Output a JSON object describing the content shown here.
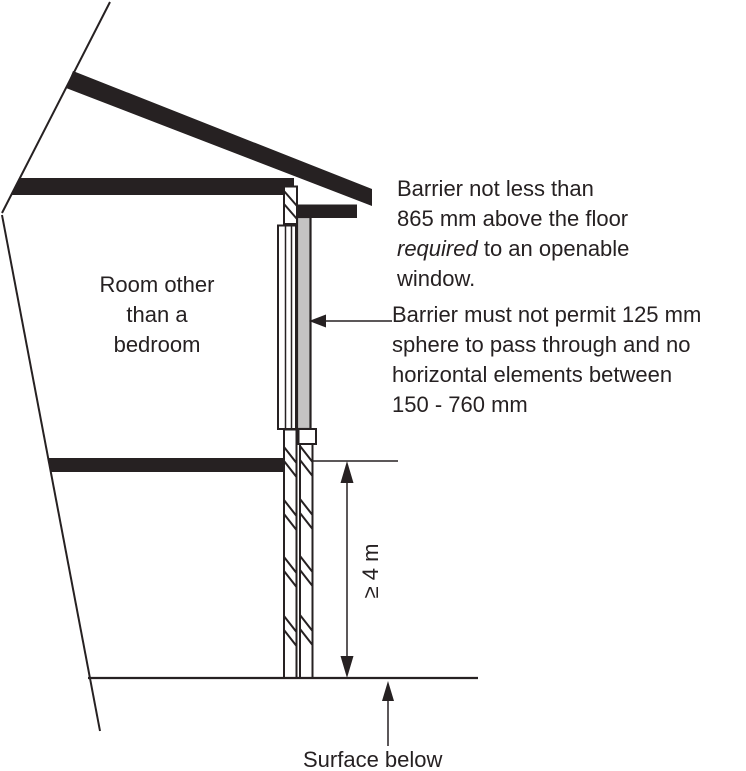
{
  "room": {
    "lines": [
      "Room other",
      "than a",
      "bedroom"
    ]
  },
  "annotations": {
    "barrier_height": {
      "line1": "Barrier not less than",
      "line2": "865 mm above the floor",
      "line3_italic": "required",
      "line3_rest": " to an openable",
      "line4": "window."
    },
    "barrier_sphere": {
      "line1": "Barrier must not permit 125 mm",
      "line2": "sphere to pass through and no",
      "line3": "horizontal elements between",
      "line4": "150 - 760 mm"
    }
  },
  "dimension": {
    "label": "≥ 4 m"
  },
  "surface": {
    "label": "Surface below"
  },
  "icons": {
    "dimension_arrow": "double-headed-vertical-arrow",
    "sphere_pointer": "left-arrow",
    "surface_pointer": "up-arrow"
  },
  "colors": {
    "line": "#262122",
    "glass": "#c4c3c3",
    "bg": "#ffffff"
  }
}
